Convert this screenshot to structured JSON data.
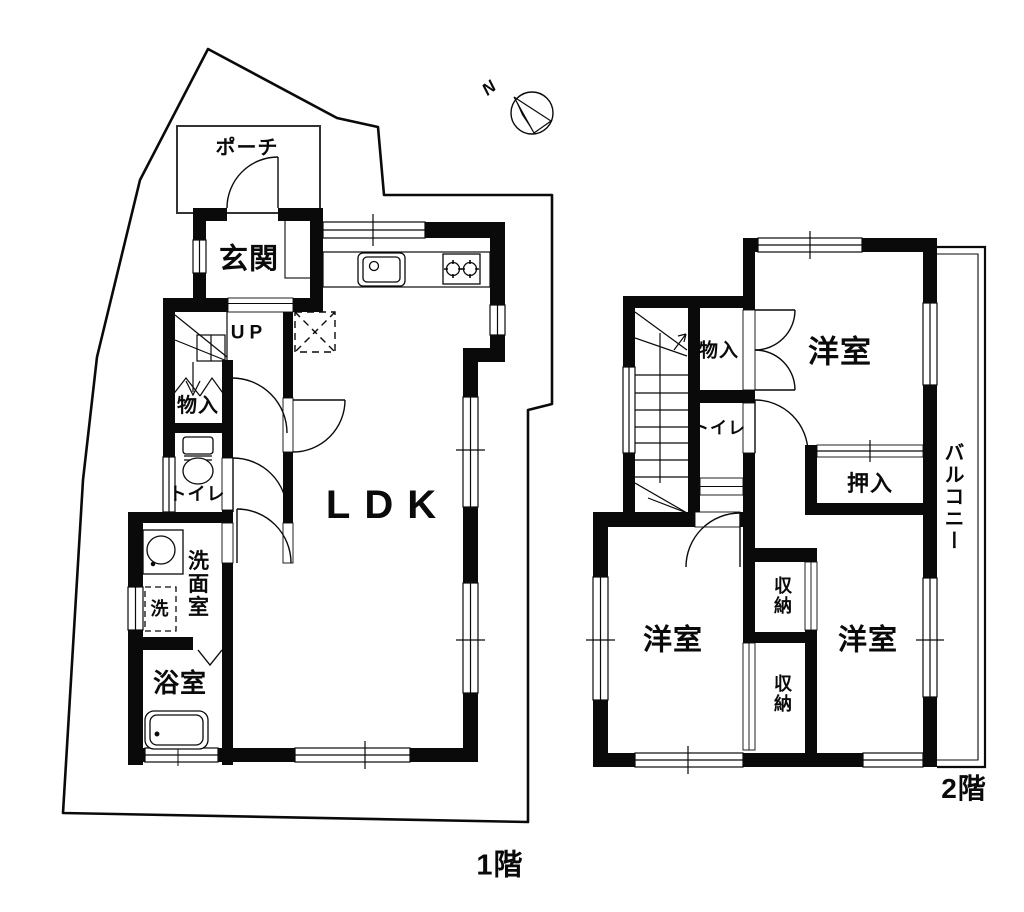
{
  "compass": {
    "north_label": "N"
  },
  "floor1": {
    "label": "1階",
    "rooms": {
      "porch": "ポーチ",
      "entrance": "玄関",
      "stairs_up": "UP",
      "storage": "物入",
      "toilet": "トイレ",
      "washroom": "洗面室",
      "washer": "洗",
      "bathroom": "浴室",
      "ldk": "LDK"
    }
  },
  "floor2": {
    "label": "2階",
    "rooms": {
      "storage": "物入",
      "toilet": "トイレ",
      "bedroom_top": "洋室",
      "oshiire": "押入",
      "bedroom_left": "洋室",
      "bedroom_right": "洋室",
      "closet_upper": "収納",
      "closet_lower": "収納",
      "balcony": "バルコニー"
    }
  }
}
